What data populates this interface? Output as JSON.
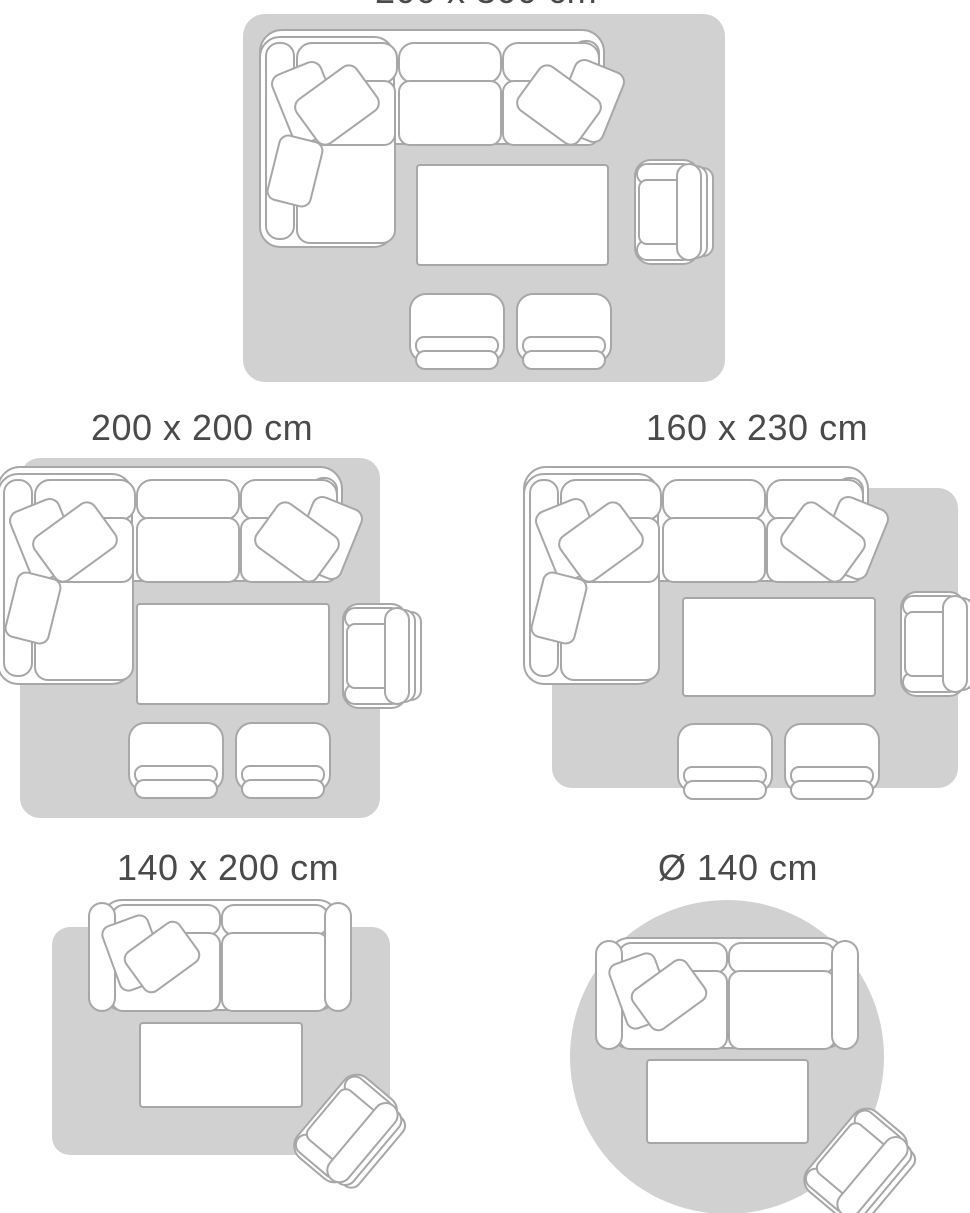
{
  "title": "rug size guide",
  "colors": {
    "rug_fill": "#d1d1d1",
    "furniture_outline": "#a7a7a7",
    "furniture_fill": "#ffffff",
    "label_color": "#4a4a4a"
  },
  "layouts": [
    {
      "id": "layout-200x300",
      "size_label": "200 x 300 cm",
      "rug_shape": "rectangle",
      "label_cropped_at_top": true,
      "furniture": [
        "corner-sofa-with-pillows",
        "coffee-table",
        "armchair",
        "pouf",
        "pouf"
      ]
    },
    {
      "id": "layout-200x200",
      "size_label": "200 x 200 cm",
      "rug_shape": "rectangle",
      "furniture": [
        "corner-sofa-with-pillows",
        "coffee-table",
        "armchair",
        "pouf",
        "pouf"
      ]
    },
    {
      "id": "layout-160x230",
      "size_label": "160 x 230 cm",
      "rug_shape": "rectangle",
      "furniture": [
        "corner-sofa-with-pillows",
        "coffee-table",
        "armchair",
        "pouf",
        "pouf"
      ]
    },
    {
      "id": "layout-140x200",
      "size_label": "140 x 200 cm",
      "rug_shape": "rectangle",
      "furniture": [
        "two-seat-sofa-with-pillows",
        "coffee-table",
        "angled-armchair"
      ]
    },
    {
      "id": "layout-140-round",
      "size_label": "Ø 140 cm",
      "rug_shape": "circle",
      "furniture": [
        "two-seat-sofa-with-pillows",
        "coffee-table",
        "angled-armchair"
      ]
    }
  ]
}
